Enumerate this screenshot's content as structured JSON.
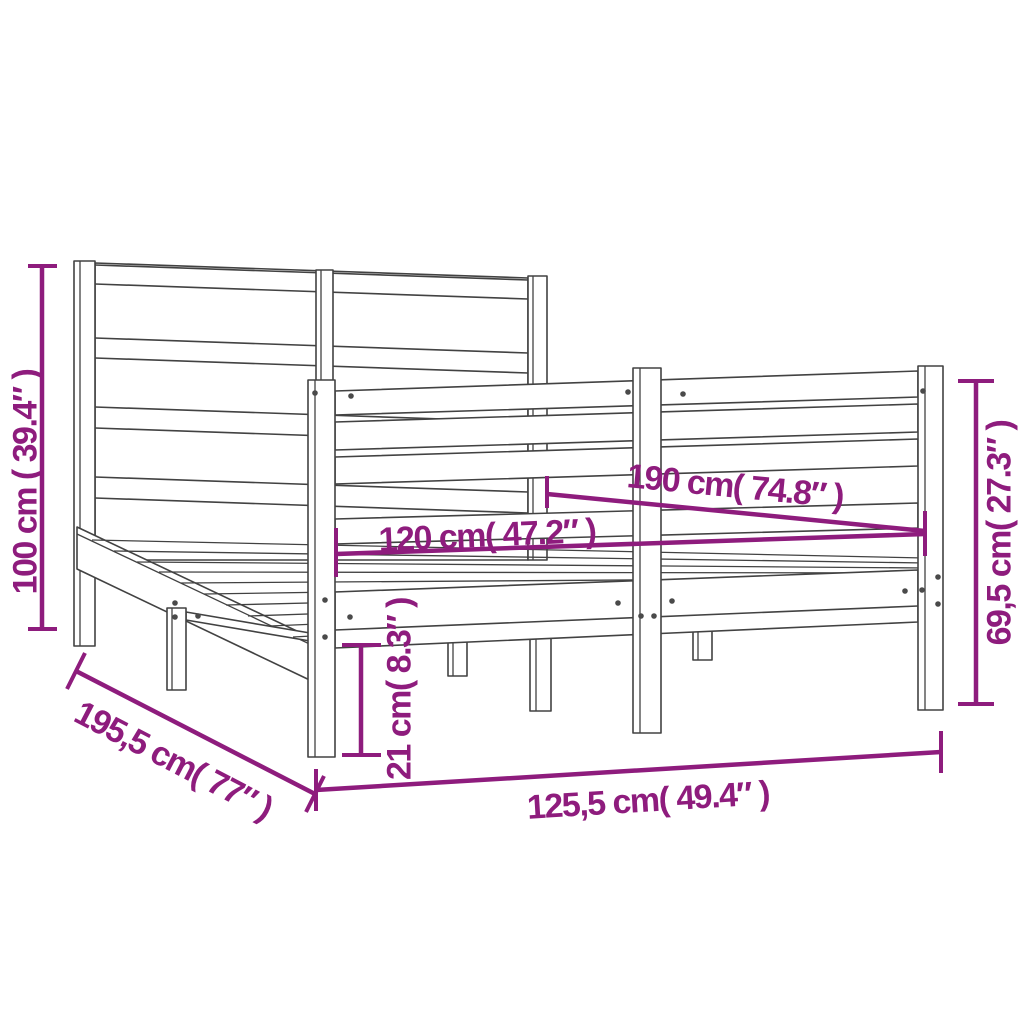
{
  "diagram": {
    "type": "product-dimension-diagram",
    "subject": "wooden bed frame with headboard",
    "colors": {
      "background": "#ffffff",
      "line_art": "#424242",
      "dimension_annotation": "#8e1c7d"
    },
    "dimensions": [
      {
        "name": "headboard-height",
        "label": "100 cm ( 39.4″ )",
        "cm": "100",
        "inch": "39.4"
      },
      {
        "name": "bed-length",
        "label": "190 cm( 74.8″ )",
        "cm": "190",
        "inch": "74.8"
      },
      {
        "name": "bed-width",
        "label": "120 cm( 47.2″ )",
        "cm": "120",
        "inch": "47.2"
      },
      {
        "name": "footboard-height",
        "label": "69,5 cm( 27.3″ )",
        "cm": "69,5",
        "inch": "27.3"
      },
      {
        "name": "rail-height",
        "label": "21 cm( 8.3″ )",
        "cm": "21",
        "inch": "8.3"
      },
      {
        "name": "total-length",
        "label": "195,5 cm( 77″ )",
        "cm": "195,5",
        "inch": "77"
      },
      {
        "name": "total-width",
        "label": "125,5 cm( 49.4″ )",
        "cm": "125,5",
        "inch": "49.4"
      }
    ]
  }
}
